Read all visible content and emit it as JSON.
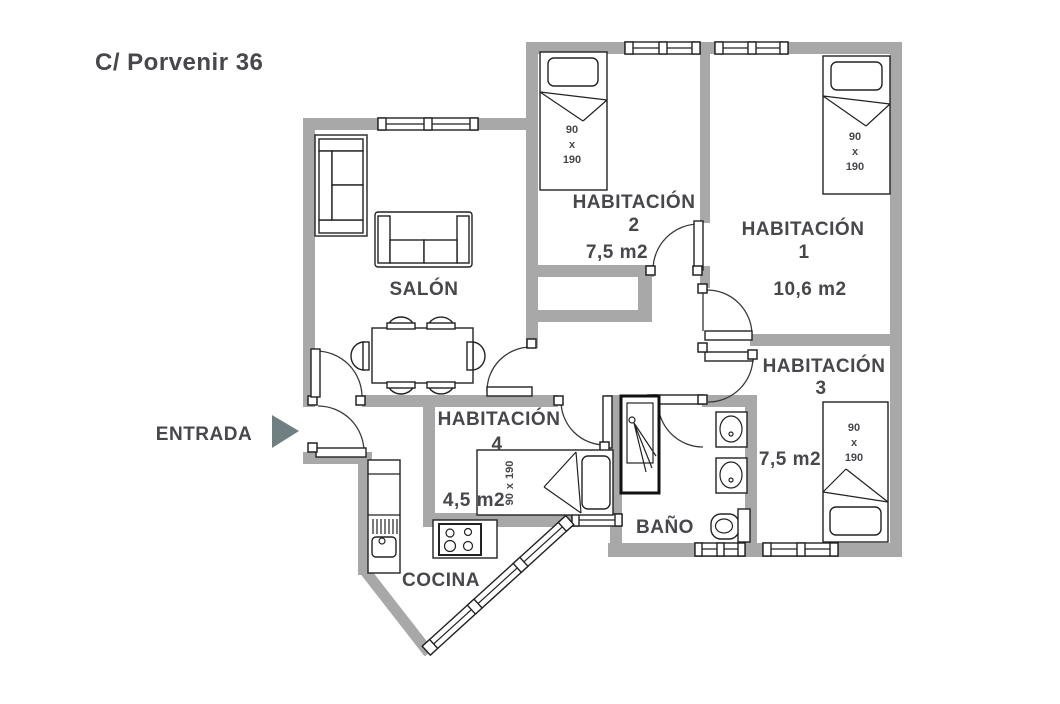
{
  "title": "C/ Porvenir 36",
  "entrance": {
    "label": "ENTRADA"
  },
  "rooms": {
    "salon": {
      "name": "SALÓN"
    },
    "habitacion1": {
      "name": "HABITACIÓN",
      "number": "1",
      "area": "10,6  m2"
    },
    "habitacion2": {
      "name": "HABITACIÓN",
      "number": "2",
      "area": "7,5 m2"
    },
    "habitacion3": {
      "name": "HABITACIÓN",
      "number": "3",
      "area": "7,5 m2"
    },
    "habitacion4": {
      "name": "HABITACIÓN",
      "number": "4",
      "area": "4,5 m2"
    },
    "bano": {
      "name": "BAÑO"
    },
    "cocina": {
      "name": "COCINA"
    }
  },
  "bed_size": {
    "width": "90",
    "separator": "x",
    "length": "190"
  },
  "colors": {
    "wall": "#a8a8a8",
    "text": "#47474c",
    "arrow": "#6f7f82",
    "line": "#222222"
  }
}
